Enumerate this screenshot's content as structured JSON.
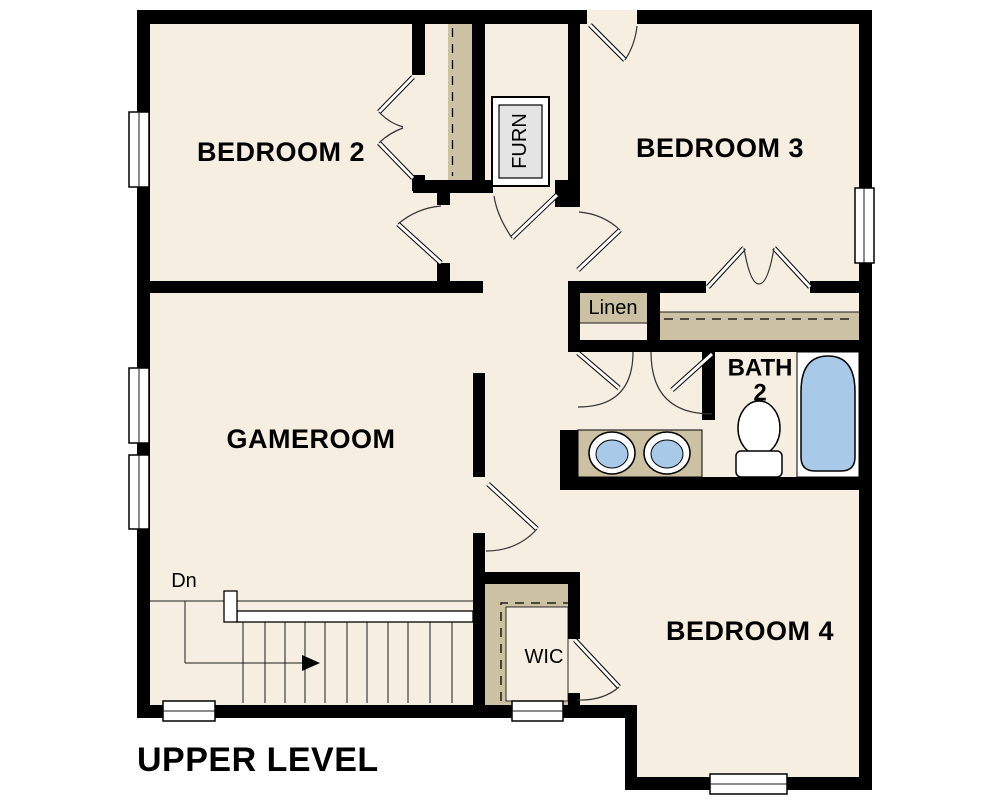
{
  "plan": {
    "title": "UPPER LEVEL",
    "rooms": [
      {
        "id": "bedroom-2",
        "label": "BEDROOM 2"
      },
      {
        "id": "bedroom-3",
        "label": "BEDROOM 3"
      },
      {
        "id": "gameroom",
        "label": "GAMEROOM"
      },
      {
        "id": "bedroom-4",
        "label": "BEDROOM 4"
      },
      {
        "id": "bath-2",
        "label_line1": "BATH",
        "label_line2": "2"
      },
      {
        "id": "linen-closet",
        "label": "Linen"
      },
      {
        "id": "walk-in-closet",
        "label": "WIC"
      },
      {
        "id": "furnace-closet",
        "label": "FURN"
      }
    ],
    "stairs": {
      "direction_label": "Dn"
    },
    "fixtures": [
      "bathtub",
      "toilet",
      "double-sink-vanity"
    ],
    "window_count": 7,
    "colors": {
      "bg": "#ffffff",
      "wall": "#000000",
      "floor": "#f5eee1",
      "tan": "#cdc1a4",
      "blue": "#a9c9e9",
      "gray": "#e4e4e4",
      "line": "#1a1a1a"
    }
  }
}
